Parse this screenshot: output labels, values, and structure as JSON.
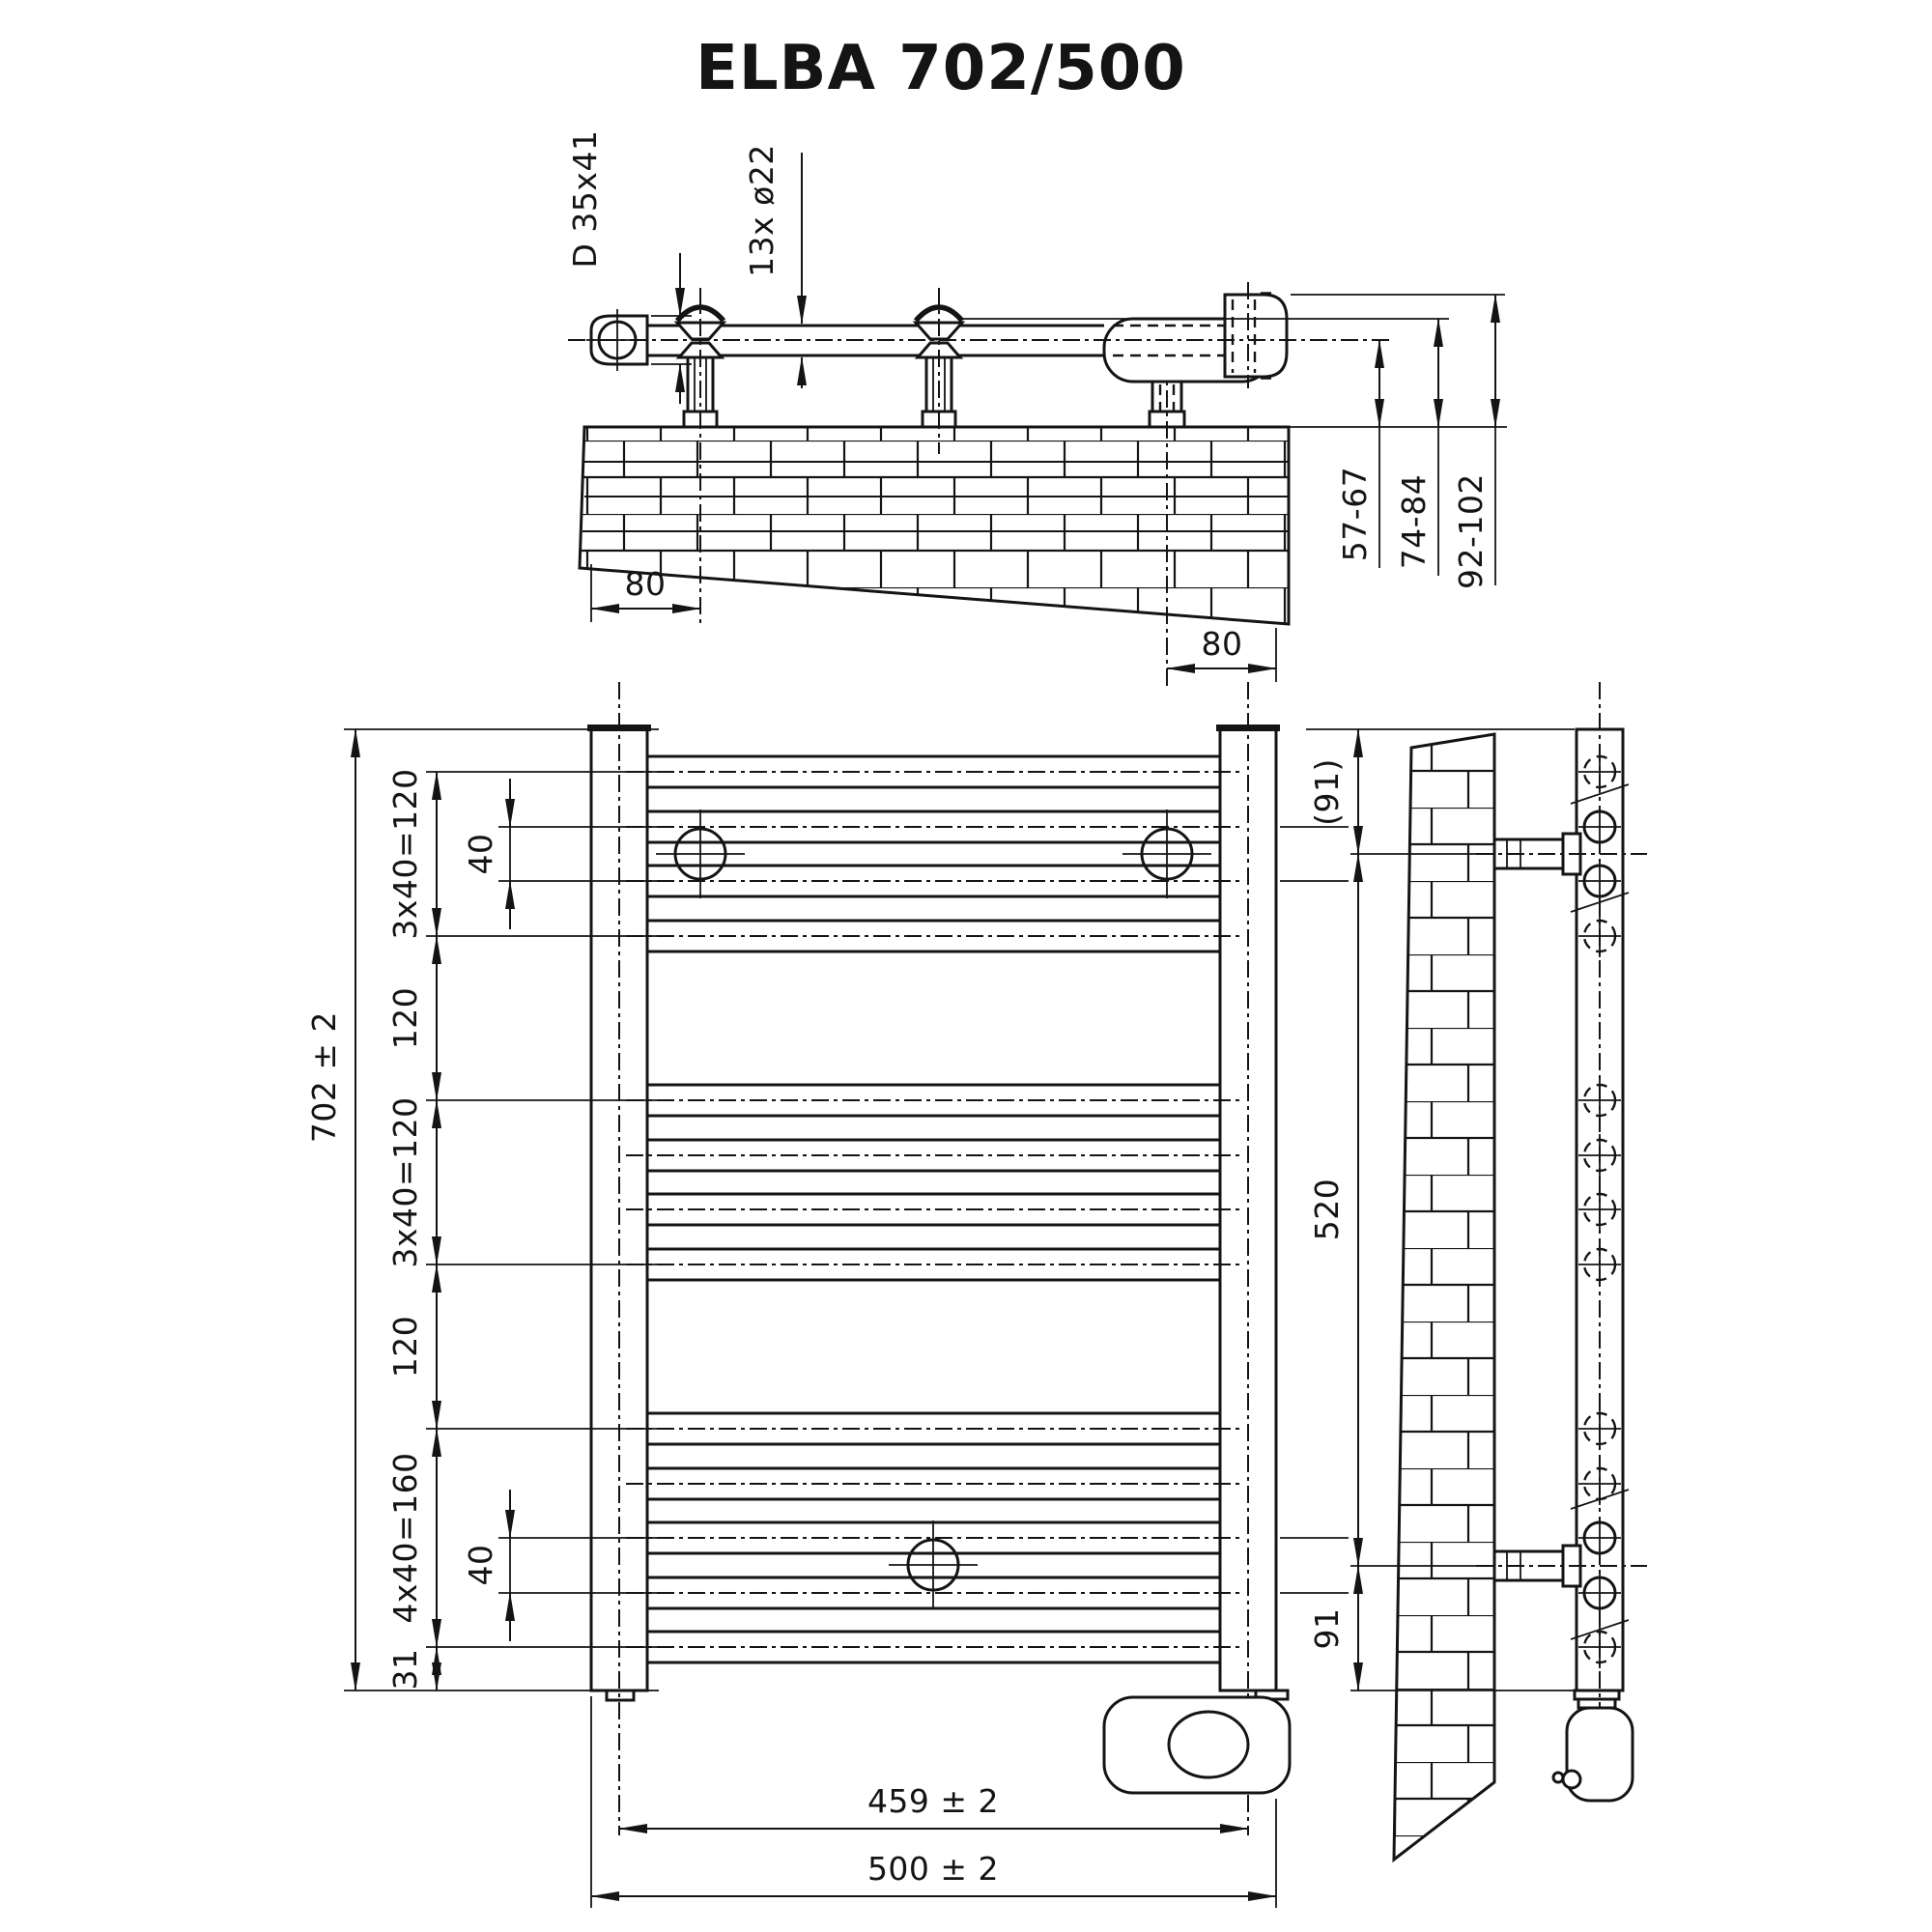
{
  "title": "ELBA 702/500",
  "specs": {
    "model": "ELBA",
    "height_mm": 702,
    "width_mm": 500,
    "tube_count": 13,
    "tube_diameter_mm": 22,
    "collector_profile": "D 35x41",
    "connection_spacing_mm": 459,
    "bracket_span_mm": 520
  },
  "top_view": {
    "labels": {
      "profile": "D 35x41",
      "tube_count": "13x ø22",
      "offset_left": "80",
      "offset_right": "80",
      "wall_to_center": "57-67",
      "wall_to_housing": "74-84",
      "wall_to_element": "92-102"
    }
  },
  "front_view": {
    "labels": {
      "overall_height": "702 ± 2",
      "group_top": "3x40=120",
      "gap_upper": "120",
      "group_mid": "3x40=120",
      "gap_lower": "120",
      "group_bottom": "4x40=160",
      "bottom_margin": "31",
      "pitch_upper": "40",
      "pitch_lower": "40",
      "connection_spacing": "459 ± 2",
      "overall_width": "500 ± 2"
    }
  },
  "side_view": {
    "labels": {
      "top_bracket": "(91)",
      "bracket_spacing": "520",
      "bottom_bracket": "91"
    }
  }
}
